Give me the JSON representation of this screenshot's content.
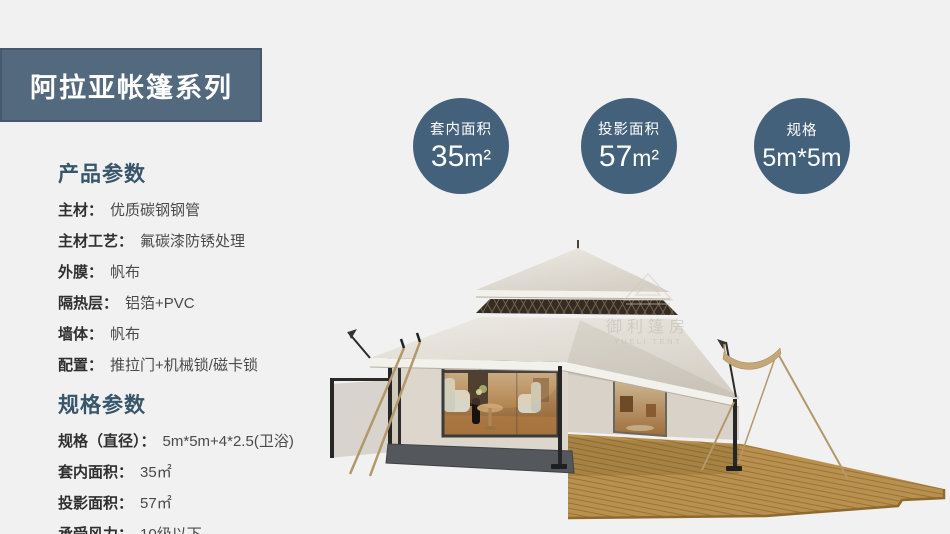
{
  "banner": {
    "title": "阿拉亚帐篷系列"
  },
  "badges": [
    {
      "label": "套内面积",
      "value": "35",
      "unit": "m²"
    },
    {
      "label": "投影面积",
      "value": "57",
      "unit": "m²"
    },
    {
      "label": "规格",
      "value": "5m*5m",
      "unit": ""
    }
  ],
  "product_params": {
    "heading": "产品参数",
    "rows": [
      {
        "label": "主材：",
        "value": "优质碳钢钢管"
      },
      {
        "label": "主材工艺：",
        "value": "氟碳漆防锈处理"
      },
      {
        "label": "外膜：",
        "value": "帆布"
      },
      {
        "label": "隔热层：",
        "value": "铝箔+PVC"
      },
      {
        "label": "墙体：",
        "value": "帆布"
      },
      {
        "label": "配置：",
        "value": "推拉门+机械锁/磁卡锁"
      }
    ]
  },
  "spec_params": {
    "heading": "规格参数",
    "rows": [
      {
        "label": "规格（直径）：",
        "value": "5m*5m+4*2.5(卫浴)"
      },
      {
        "label": "套内面积：",
        "value": "35㎡"
      },
      {
        "label": "投影面积：",
        "value": "57㎡"
      },
      {
        "label": "承受风力：",
        "value": "10级以下"
      }
    ]
  },
  "watermark": {
    "cn": "御利篷房",
    "en": "YUELI TENT"
  },
  "colors": {
    "page-bg": "#f1f1f2",
    "banner-bg": "#53697d",
    "banner-border": "#46586b",
    "banner-text": "#ffffff",
    "badge-bg": "#44617b",
    "badge-text": "#ffffff",
    "heading": "#38566a",
    "label": "#2f2f2f",
    "value": "#4a4a4a"
  }
}
